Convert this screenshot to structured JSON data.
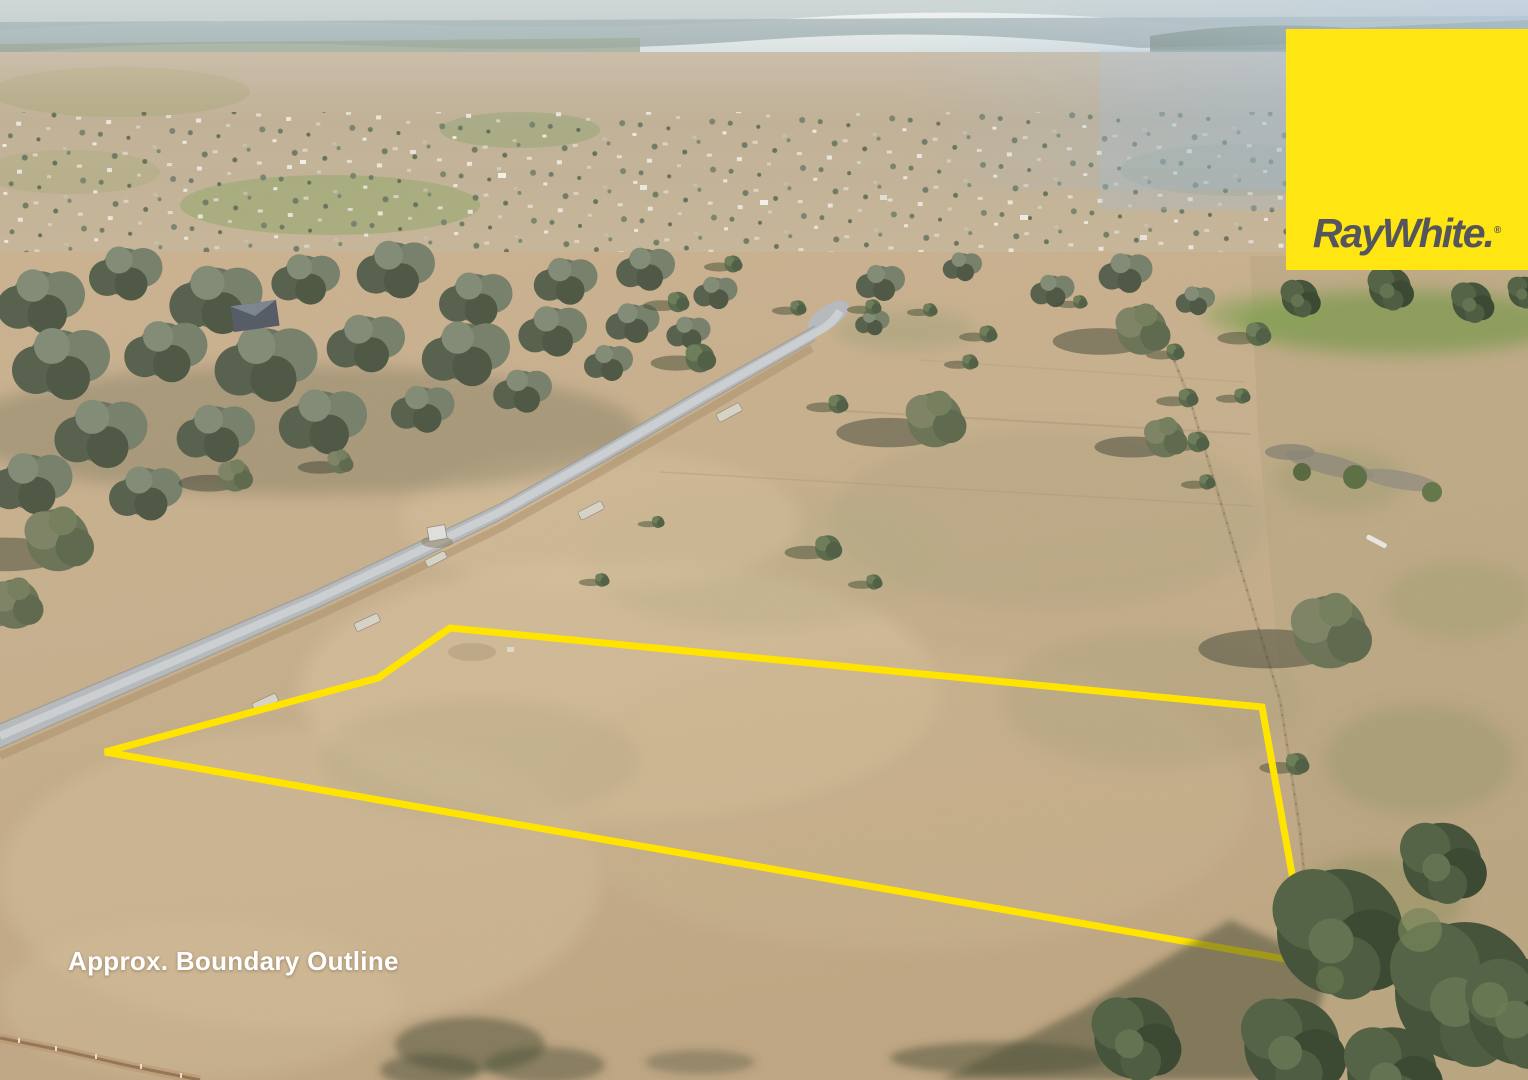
{
  "image": {
    "kind": "aerial-drone-photograph",
    "subject": "vacant rural land parcel beside a sealed road with dry paddocks, scattered gum trees and a distant country township"
  },
  "overlay": {
    "caption": "Approx. Boundary Outline",
    "boundary_color": "#FFE400",
    "boundary_points": "450,628 1262,707 1308,963 105,752 378,678"
  },
  "branding": {
    "logo_text": "RayWhite.",
    "registered_mark": "®",
    "logo_bg_color": "#FFE512",
    "logo_text_color": "#54565C"
  }
}
